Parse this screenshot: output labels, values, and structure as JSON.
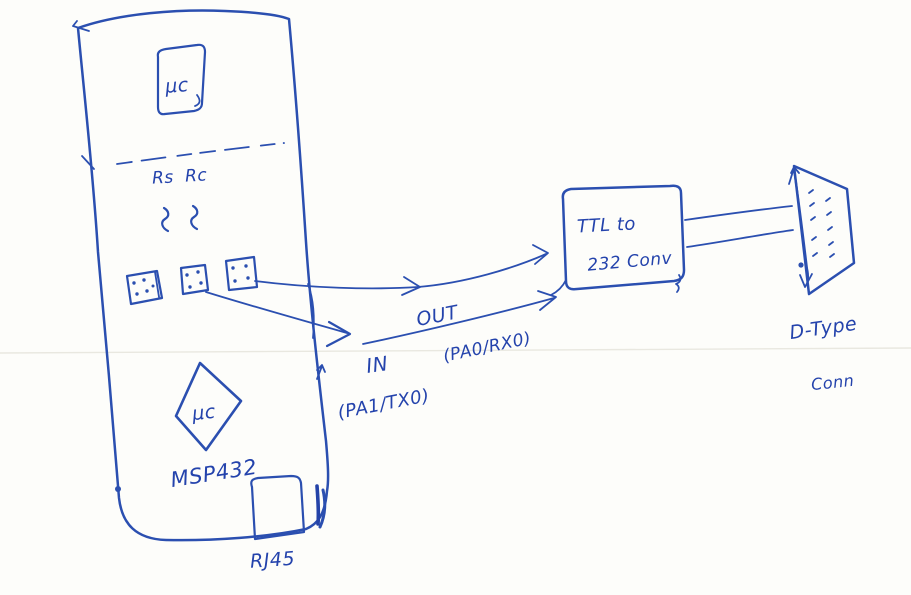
{
  "page": {
    "ink_color": "#2b4fb0",
    "paper_color": "#fdfdfa",
    "scanline_color": "#e9e8e0"
  },
  "board": {
    "chip_top_label": "μc",
    "resistor_label_1": "Rs",
    "resistor_label_2": "Rc",
    "chip_bottom_label": "μc",
    "board_name": "MSP432",
    "jack_label": "RJ45"
  },
  "signals": {
    "out_label": "OUT",
    "out_pins": "(PA0/RX0)",
    "in_label": "IN",
    "in_pins": "(PA1/TX0)"
  },
  "converter": {
    "line1": "TTL to",
    "line2": "232 Conv"
  },
  "connector": {
    "line1": "D-Type",
    "line2": "Conn"
  }
}
